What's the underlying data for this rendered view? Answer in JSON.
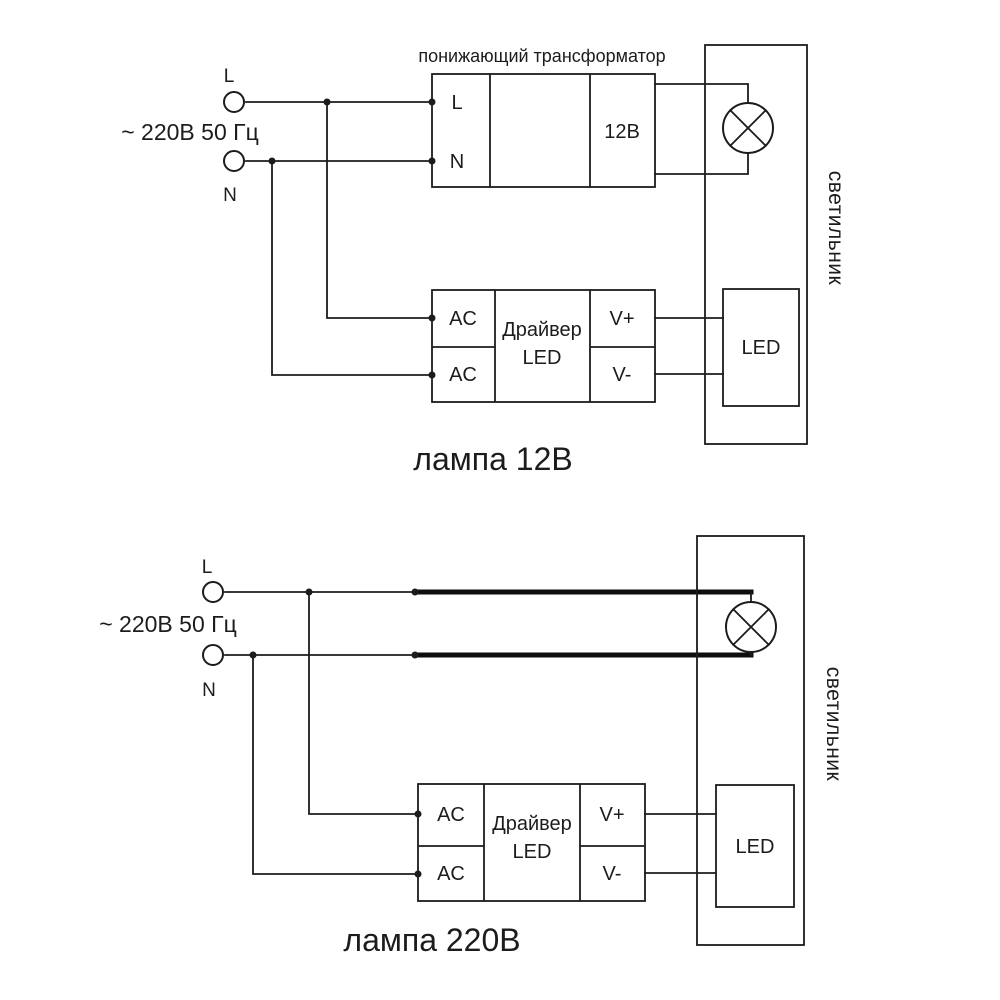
{
  "colors": {
    "background": "#ffffff",
    "ink": "#1c1c1c"
  },
  "diagram_top": {
    "caption": "лампа 12В",
    "source": {
      "label": "~ 220В 50 Гц",
      "line_terminal": "L",
      "neutral_terminal": "N"
    },
    "transformer": {
      "title": "понижающий трансформатор",
      "input_line": "L",
      "input_neutral": "N",
      "output_voltage": "12В"
    },
    "driver": {
      "input_top": "AC",
      "input_bottom": "AC",
      "name_line1": "Драйвер",
      "name_line2": "LED",
      "output_positive": "V+",
      "output_negative": "V-"
    },
    "led_module": "LED",
    "luminaire": "светильник"
  },
  "diagram_bottom": {
    "caption": "лампа 220В",
    "source": {
      "label": "~ 220В 50 Гц",
      "line_terminal": "L",
      "neutral_terminal": "N"
    },
    "driver": {
      "input_top": "AC",
      "input_bottom": "AC",
      "name_line1": "Драйвер",
      "name_line2": "LED",
      "output_positive": "V+",
      "output_negative": "V-"
    },
    "led_module": "LED",
    "luminaire": "светильник"
  }
}
